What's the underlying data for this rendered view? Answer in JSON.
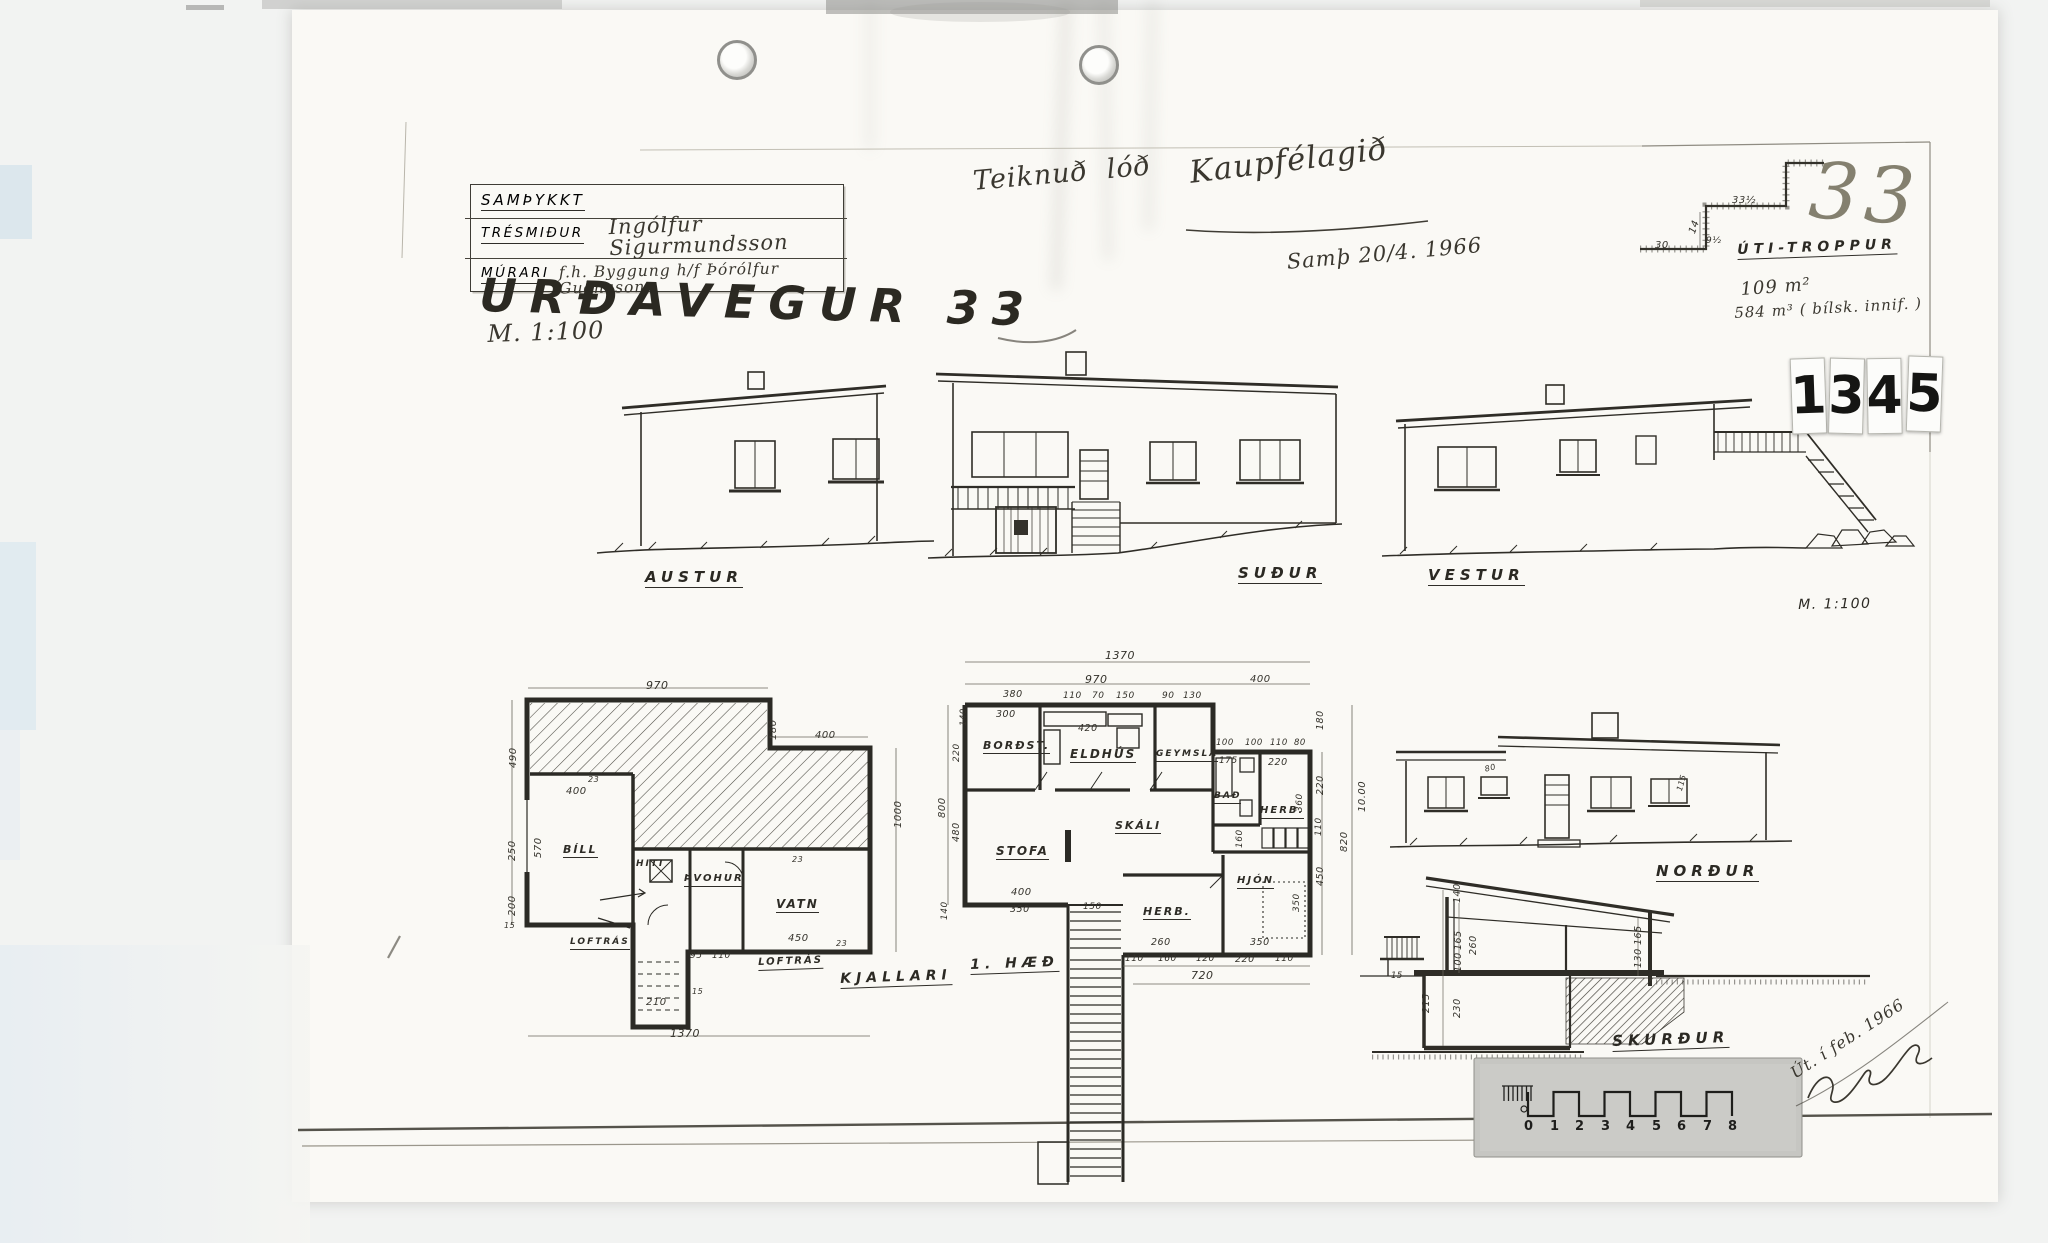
{
  "document": {
    "approval_block": {
      "approved_label": "SAMÞYKKT",
      "carpenter_label": "TRÉSMIÐUR",
      "carpenter_signature": "Ingólfur Sigurmundsson",
      "mason_label": "MÚRARI",
      "mason_signature": "f.h. Byggung h/f  Þórólfur Guðnason"
    },
    "stamp_digits": [
      "1",
      "3",
      "4",
      "5"
    ]
  },
  "labels": [
    {
      "n": "sheet-title",
      "t": "URÐAVEGUR 33",
      "x": 480,
      "y": 272,
      "s": 46,
      "r": 1.5,
      "c": "title"
    },
    {
      "n": "sheet-scale-note",
      "t": "M. 1:100",
      "x": 487,
      "y": 322,
      "s": 24,
      "r": -2,
      "c": "hw"
    },
    {
      "n": "note-drawn-for",
      "t": "Teiknuð  lóð",
      "x": 972,
      "y": 168,
      "s": 27,
      "r": -5,
      "c": "hw"
    },
    {
      "n": "note-client",
      "t": "Kaupfélagið",
      "x": 1188,
      "y": 158,
      "s": 31,
      "r": -7,
      "c": "hw"
    },
    {
      "n": "note-approval-date",
      "t": "Samþ 20/4. 1966",
      "x": 1286,
      "y": 252,
      "s": 21,
      "r": -5,
      "c": "hw"
    },
    {
      "n": "sheet-number-pencil",
      "t": "33",
      "x": 1812,
      "y": 152,
      "s": 78,
      "r": 4,
      "c": "pencil"
    },
    {
      "n": "stair-detail-label",
      "t": "ÚTI-TROPPUR",
      "x": 1737,
      "y": 243,
      "s": 14,
      "r": -2,
      "c": "elev u"
    },
    {
      "n": "note-floor-area",
      "t": "109 m²",
      "x": 1740,
      "y": 281,
      "s": 18,
      "r": -4,
      "c": "hw"
    },
    {
      "n": "note-volume",
      "t": "584 m³ ( bílsk. innif. )",
      "x": 1734,
      "y": 306,
      "s": 15,
      "r": -3,
      "c": "hw"
    },
    {
      "n": "elevation-label-austur",
      "t": "AUSTUR",
      "x": 645,
      "y": 570,
      "s": 15,
      "c": "elev u"
    },
    {
      "n": "elevation-label-sudur",
      "t": "SUÐUR",
      "x": 1238,
      "y": 566,
      "s": 15,
      "c": "elev u"
    },
    {
      "n": "elevation-label-vestur",
      "t": "VESTUR",
      "x": 1428,
      "y": 568,
      "s": 15,
      "c": "elev u"
    },
    {
      "n": "scale-note-right",
      "t": "M. 1:100",
      "x": 1798,
      "y": 598,
      "s": 14,
      "r": -1,
      "c": "hp"
    },
    {
      "n": "elevation-label-nordur",
      "t": "NORÐUR",
      "x": 1656,
      "y": 864,
      "s": 15,
      "c": "elev u"
    },
    {
      "n": "section-label",
      "t": "SKURÐUR",
      "x": 1612,
      "y": 1034,
      "s": 15,
      "r": -2,
      "c": "elev u"
    },
    {
      "n": "plan-label-kjallari",
      "t": "KJALLARI",
      "x": 840,
      "y": 972,
      "s": 14,
      "r": -2,
      "c": "elev u"
    },
    {
      "n": "plan-label-first-floor",
      "t": "1. HÆÐ",
      "x": 970,
      "y": 958,
      "s": 14,
      "r": -2,
      "c": "elev u"
    },
    {
      "n": "room-label-bill",
      "t": "BÍLL",
      "x": 563,
      "y": 844,
      "s": 11,
      "c": "room u"
    },
    {
      "n": "room-label-hiti",
      "t": "HITI",
      "x": 636,
      "y": 860,
      "s": 9,
      "c": "room"
    },
    {
      "n": "room-label-thvohur",
      "t": "ÞVOHUR",
      "x": 684,
      "y": 874,
      "s": 10,
      "c": "room u"
    },
    {
      "n": "room-label-vatn",
      "t": "VATN",
      "x": 776,
      "y": 898,
      "s": 12,
      "c": "room u"
    },
    {
      "n": "room-label-loftras-1",
      "t": "LOFTRÁS",
      "x": 570,
      "y": 938,
      "s": 9,
      "c": "room u"
    },
    {
      "n": "room-label-loftras-2",
      "t": "LOFTRÁS",
      "x": 758,
      "y": 958,
      "s": 10,
      "r": -2,
      "c": "room u"
    },
    {
      "n": "room-label-bordst",
      "t": "BORÐST.",
      "x": 983,
      "y": 740,
      "s": 11,
      "c": "room u"
    },
    {
      "n": "room-label-eldhus",
      "t": "ELDHÚS",
      "x": 1070,
      "y": 748,
      "s": 12,
      "c": "room u"
    },
    {
      "n": "room-label-geymsla",
      "t": "GEYMSLA",
      "x": 1156,
      "y": 750,
      "s": 9,
      "c": "room u"
    },
    {
      "n": "room-label-bad",
      "t": "BAÐ",
      "x": 1214,
      "y": 792,
      "s": 9,
      "c": "room u"
    },
    {
      "n": "room-label-herb-top",
      "t": "HERB.",
      "x": 1260,
      "y": 806,
      "s": 10,
      "c": "room u"
    },
    {
      "n": "room-label-skali",
      "t": "SKÁLI",
      "x": 1115,
      "y": 820,
      "s": 11,
      "c": "room u"
    },
    {
      "n": "room-label-stofa",
      "t": "STOFA",
      "x": 996,
      "y": 845,
      "s": 12,
      "c": "room u"
    },
    {
      "n": "room-label-herb-bottom",
      "t": "HERB.",
      "x": 1143,
      "y": 906,
      "s": 11,
      "c": "room u"
    },
    {
      "n": "room-label-hjon",
      "t": "HJÓN",
      "x": 1237,
      "y": 876,
      "s": 10,
      "c": "room u"
    },
    {
      "n": "stair-detail-dim",
      "t": "33½",
      "x": 1732,
      "y": 196,
      "s": 10,
      "c": "dim"
    },
    {
      "n": "stair-detail-dim",
      "t": "14",
      "x": 1688,
      "y": 232,
      "s": 10,
      "r": -70,
      "c": "dim"
    },
    {
      "n": "stair-detail-dim",
      "t": "9½",
      "x": 1706,
      "y": 237,
      "s": 9,
      "c": "dim"
    },
    {
      "n": "stair-detail-dim",
      "t": "30",
      "x": 1655,
      "y": 241,
      "s": 10,
      "c": "dim"
    },
    {
      "n": "dim-label",
      "t": "970",
      "x": 646,
      "y": 680,
      "s": 11,
      "c": "dim"
    },
    {
      "n": "dim-label",
      "t": "400",
      "x": 815,
      "y": 731,
      "s": 10,
      "c": "dim"
    },
    {
      "n": "dim-label",
      "t": "180",
      "x": 769,
      "y": 740,
      "s": 10,
      "r": -90,
      "c": "dim"
    },
    {
      "n": "dim-label",
      "t": "490",
      "x": 509,
      "y": 768,
      "s": 10,
      "r": -90,
      "c": "dim"
    },
    {
      "n": "dim-label",
      "t": "400",
      "x": 566,
      "y": 787,
      "s": 10,
      "c": "dim"
    },
    {
      "n": "dim-label",
      "t": "570",
      "x": 534,
      "y": 858,
      "s": 10,
      "r": -90,
      "c": "dim"
    },
    {
      "n": "dim-label",
      "t": "250",
      "x": 508,
      "y": 861,
      "s": 10,
      "r": -90,
      "c": "dim"
    },
    {
      "n": "dim-label",
      "t": "200",
      "x": 508,
      "y": 916,
      "s": 10,
      "r": -90,
      "c": "dim"
    },
    {
      "n": "dim-label",
      "t": "1000",
      "x": 894,
      "y": 828,
      "s": 10,
      "r": -90,
      "c": "dim"
    },
    {
      "n": "dim-label",
      "t": "800",
      "x": 938,
      "y": 818,
      "s": 10,
      "r": -90,
      "c": "dim"
    },
    {
      "n": "dim-label",
      "t": "450",
      "x": 788,
      "y": 934,
      "s": 10,
      "c": "dim"
    },
    {
      "n": "dim-label",
      "t": "95",
      "x": 690,
      "y": 952,
      "s": 9,
      "c": "dim"
    },
    {
      "n": "dim-label",
      "t": "110",
      "x": 712,
      "y": 952,
      "s": 9,
      "c": "dim"
    },
    {
      "n": "dim-label",
      "t": "210",
      "x": 646,
      "y": 998,
      "s": 10,
      "c": "dim"
    },
    {
      "n": "dim-label",
      "t": "1370",
      "x": 670,
      "y": 1028,
      "s": 11,
      "c": "dim"
    },
    {
      "n": "dim-label",
      "t": "15",
      "x": 504,
      "y": 922,
      "s": 8,
      "c": "dim"
    },
    {
      "n": "dim-label",
      "t": "23",
      "x": 588,
      "y": 776,
      "s": 8,
      "c": "dim"
    },
    {
      "n": "dim-label",
      "t": "23",
      "x": 792,
      "y": 856,
      "s": 8,
      "c": "dim"
    },
    {
      "n": "dim-label",
      "t": "23",
      "x": 836,
      "y": 940,
      "s": 8,
      "c": "dim"
    },
    {
      "n": "dim-label",
      "t": "15",
      "x": 692,
      "y": 988,
      "s": 8,
      "c": "dim"
    },
    {
      "n": "dim-label",
      "t": "1370",
      "x": 1105,
      "y": 650,
      "s": 11,
      "c": "dim"
    },
    {
      "n": "dim-label",
      "t": "970",
      "x": 1085,
      "y": 674,
      "s": 11,
      "c": "dim"
    },
    {
      "n": "dim-label",
      "t": "400",
      "x": 1250,
      "y": 675,
      "s": 10,
      "c": "dim"
    },
    {
      "n": "dim-label",
      "t": "380",
      "x": 1003,
      "y": 690,
      "s": 9.5,
      "c": "dim"
    },
    {
      "n": "dim-label",
      "t": "110",
      "x": 1063,
      "y": 692,
      "s": 9,
      "c": "dim"
    },
    {
      "n": "dim-label",
      "t": "70",
      "x": 1092,
      "y": 692,
      "s": 9,
      "c": "dim"
    },
    {
      "n": "dim-label",
      "t": "150",
      "x": 1116,
      "y": 692,
      "s": 9,
      "c": "dim"
    },
    {
      "n": "dim-label",
      "t": "90",
      "x": 1162,
      "y": 692,
      "s": 9,
      "c": "dim"
    },
    {
      "n": "dim-label",
      "t": "130",
      "x": 1183,
      "y": 692,
      "s": 9,
      "c": "dim"
    },
    {
      "n": "dim-label",
      "t": "300",
      "x": 996,
      "y": 710,
      "s": 9.5,
      "c": "dim"
    },
    {
      "n": "dim-label",
      "t": "420",
      "x": 1078,
      "y": 724,
      "s": 9.5,
      "c": "dim"
    },
    {
      "n": "dim-label",
      "t": "100",
      "x": 1216,
      "y": 739,
      "s": 8.5,
      "c": "dim"
    },
    {
      "n": "dim-label",
      "t": "100",
      "x": 1245,
      "y": 739,
      "s": 8.5,
      "c": "dim"
    },
    {
      "n": "dim-label",
      "t": "110",
      "x": 1270,
      "y": 739,
      "s": 8.5,
      "c": "dim"
    },
    {
      "n": "dim-label",
      "t": "80",
      "x": 1294,
      "y": 739,
      "s": 8.5,
      "c": "dim"
    },
    {
      "n": "dim-label",
      "t": "175",
      "x": 1219,
      "y": 757,
      "s": 9,
      "c": "dim"
    },
    {
      "n": "dim-label",
      "t": "220",
      "x": 1268,
      "y": 758,
      "s": 9.5,
      "c": "dim"
    },
    {
      "n": "dim-label",
      "t": "180",
      "x": 1316,
      "y": 730,
      "s": 9.5,
      "r": -90,
      "c": "dim"
    },
    {
      "n": "dim-label",
      "t": "220",
      "x": 1316,
      "y": 795,
      "s": 9.5,
      "r": -90,
      "c": "dim"
    },
    {
      "n": "dim-label",
      "t": "360",
      "x": 1296,
      "y": 812,
      "s": 9,
      "r": -90,
      "c": "dim"
    },
    {
      "n": "dim-label",
      "t": "110",
      "x": 1315,
      "y": 836,
      "s": 9,
      "r": -90,
      "c": "dim"
    },
    {
      "n": "dim-label",
      "t": "10.00",
      "x": 1358,
      "y": 812,
      "s": 10,
      "r": -90,
      "c": "dim"
    },
    {
      "n": "dim-label",
      "t": "820",
      "x": 1340,
      "y": 852,
      "s": 10,
      "r": -90,
      "c": "dim"
    },
    {
      "n": "dim-label",
      "t": "450",
      "x": 1316,
      "y": 886,
      "s": 9.5,
      "r": -90,
      "c": "dim"
    },
    {
      "n": "dim-label",
      "t": "480",
      "x": 952,
      "y": 842,
      "s": 9.5,
      "r": -90,
      "c": "dim"
    },
    {
      "n": "dim-label",
      "t": "220",
      "x": 953,
      "y": 762,
      "s": 9,
      "r": -90,
      "c": "dim"
    },
    {
      "n": "dim-label",
      "t": "140",
      "x": 960,
      "y": 726,
      "s": 8.5,
      "r": -90,
      "c": "dim"
    },
    {
      "n": "dim-label",
      "t": "400",
      "x": 1011,
      "y": 888,
      "s": 10,
      "c": "dim"
    },
    {
      "n": "dim-label",
      "t": "350",
      "x": 1010,
      "y": 905,
      "s": 9.5,
      "c": "dim"
    },
    {
      "n": "dim-label",
      "t": "150",
      "x": 1083,
      "y": 903,
      "s": 9,
      "c": "dim"
    },
    {
      "n": "dim-label",
      "t": "260",
      "x": 1151,
      "y": 938,
      "s": 9.5,
      "c": "dim"
    },
    {
      "n": "dim-label",
      "t": "350",
      "x": 1250,
      "y": 938,
      "s": 9.5,
      "c": "dim"
    },
    {
      "n": "dim-label",
      "t": "350",
      "x": 1293,
      "y": 912,
      "s": 9,
      "r": -90,
      "c": "dim"
    },
    {
      "n": "dim-label",
      "t": "160",
      "x": 1236,
      "y": 848,
      "s": 9,
      "r": -90,
      "c": "dim"
    },
    {
      "n": "dim-label",
      "t": "110",
      "x": 1125,
      "y": 955,
      "s": 9,
      "c": "dim"
    },
    {
      "n": "dim-label",
      "t": "160",
      "x": 1158,
      "y": 955,
      "s": 9,
      "c": "dim"
    },
    {
      "n": "dim-label",
      "t": "120",
      "x": 1196,
      "y": 955,
      "s": 9,
      "c": "dim"
    },
    {
      "n": "dim-label",
      "t": "220",
      "x": 1235,
      "y": 955,
      "s": 9.5,
      "c": "dim"
    },
    {
      "n": "dim-label",
      "t": "110",
      "x": 1275,
      "y": 955,
      "s": 9,
      "c": "dim"
    },
    {
      "n": "dim-label",
      "t": "720",
      "x": 1191,
      "y": 970,
      "s": 11,
      "c": "dim"
    },
    {
      "n": "dim-label",
      "t": "140",
      "x": 941,
      "y": 920,
      "s": 9,
      "r": -90,
      "c": "dim"
    },
    {
      "n": "dim-label",
      "t": "140",
      "x": 1453,
      "y": 903,
      "s": 9.5,
      "r": -90,
      "c": "dim"
    },
    {
      "n": "dim-label",
      "t": "165",
      "x": 1454,
      "y": 950,
      "s": 9.5,
      "r": -90,
      "c": "dim"
    },
    {
      "n": "dim-label",
      "t": "260",
      "x": 1469,
      "y": 955,
      "s": 9.5,
      "r": -90,
      "c": "dim"
    },
    {
      "n": "dim-label",
      "t": "100",
      "x": 1454,
      "y": 972,
      "s": 9.5,
      "r": -90,
      "c": "dim"
    },
    {
      "n": "dim-label",
      "t": "230",
      "x": 1453,
      "y": 1018,
      "s": 9.5,
      "r": -90,
      "c": "dim"
    },
    {
      "n": "dim-label",
      "t": "215",
      "x": 1422,
      "y": 1013,
      "s": 9.5,
      "r": -90,
      "c": "dim"
    },
    {
      "n": "dim-label",
      "t": "165",
      "x": 1634,
      "y": 945,
      "s": 9.5,
      "r": -90,
      "c": "dim"
    },
    {
      "n": "dim-label",
      "t": "130",
      "x": 1634,
      "y": 968,
      "s": 9.5,
      "r": -90,
      "c": "dim"
    },
    {
      "n": "dim-label",
      "t": "15",
      "x": 1391,
      "y": 972,
      "s": 8.5,
      "c": "dim"
    },
    {
      "n": "dim-label",
      "t": "80",
      "x": 1484,
      "y": 766,
      "s": 8,
      "r": -15,
      "c": "dim"
    },
    {
      "n": "dim-label",
      "t": "115",
      "x": 1676,
      "y": 790,
      "s": 8,
      "r": -75,
      "c": "dim"
    },
    {
      "n": "note-issued",
      "t": "Út. í feb. 1966",
      "x": 1788,
      "y": 1068,
      "s": 16,
      "r": -33,
      "c": "hw"
    },
    {
      "n": "scalebar-number",
      "t": "0",
      "x": 1524,
      "y": 1120,
      "s": 13,
      "c": "scnum"
    },
    {
      "n": "scalebar-number",
      "t": "1",
      "x": 1550,
      "y": 1120,
      "s": 13,
      "c": "scnum"
    },
    {
      "n": "scalebar-number",
      "t": "2",
      "x": 1575,
      "y": 1120,
      "s": 13,
      "c": "scnum"
    },
    {
      "n": "scalebar-number",
      "t": "3",
      "x": 1601,
      "y": 1120,
      "s": 13,
      "c": "scnum"
    },
    {
      "n": "scalebar-number",
      "t": "4",
      "x": 1626,
      "y": 1120,
      "s": 13,
      "c": "scnum"
    },
    {
      "n": "scalebar-number",
      "t": "5",
      "x": 1652,
      "y": 1120,
      "s": 13,
      "c": "scnum"
    },
    {
      "n": "scalebar-number",
      "t": "6",
      "x": 1677,
      "y": 1120,
      "s": 13,
      "c": "scnum"
    },
    {
      "n": "scalebar-number",
      "t": "7",
      "x": 1703,
      "y": 1120,
      "s": 13,
      "c": "scnum"
    },
    {
      "n": "scalebar-number",
      "t": "8",
      "x": 1728,
      "y": 1120,
      "s": 13,
      "c": "scnum"
    }
  ]
}
